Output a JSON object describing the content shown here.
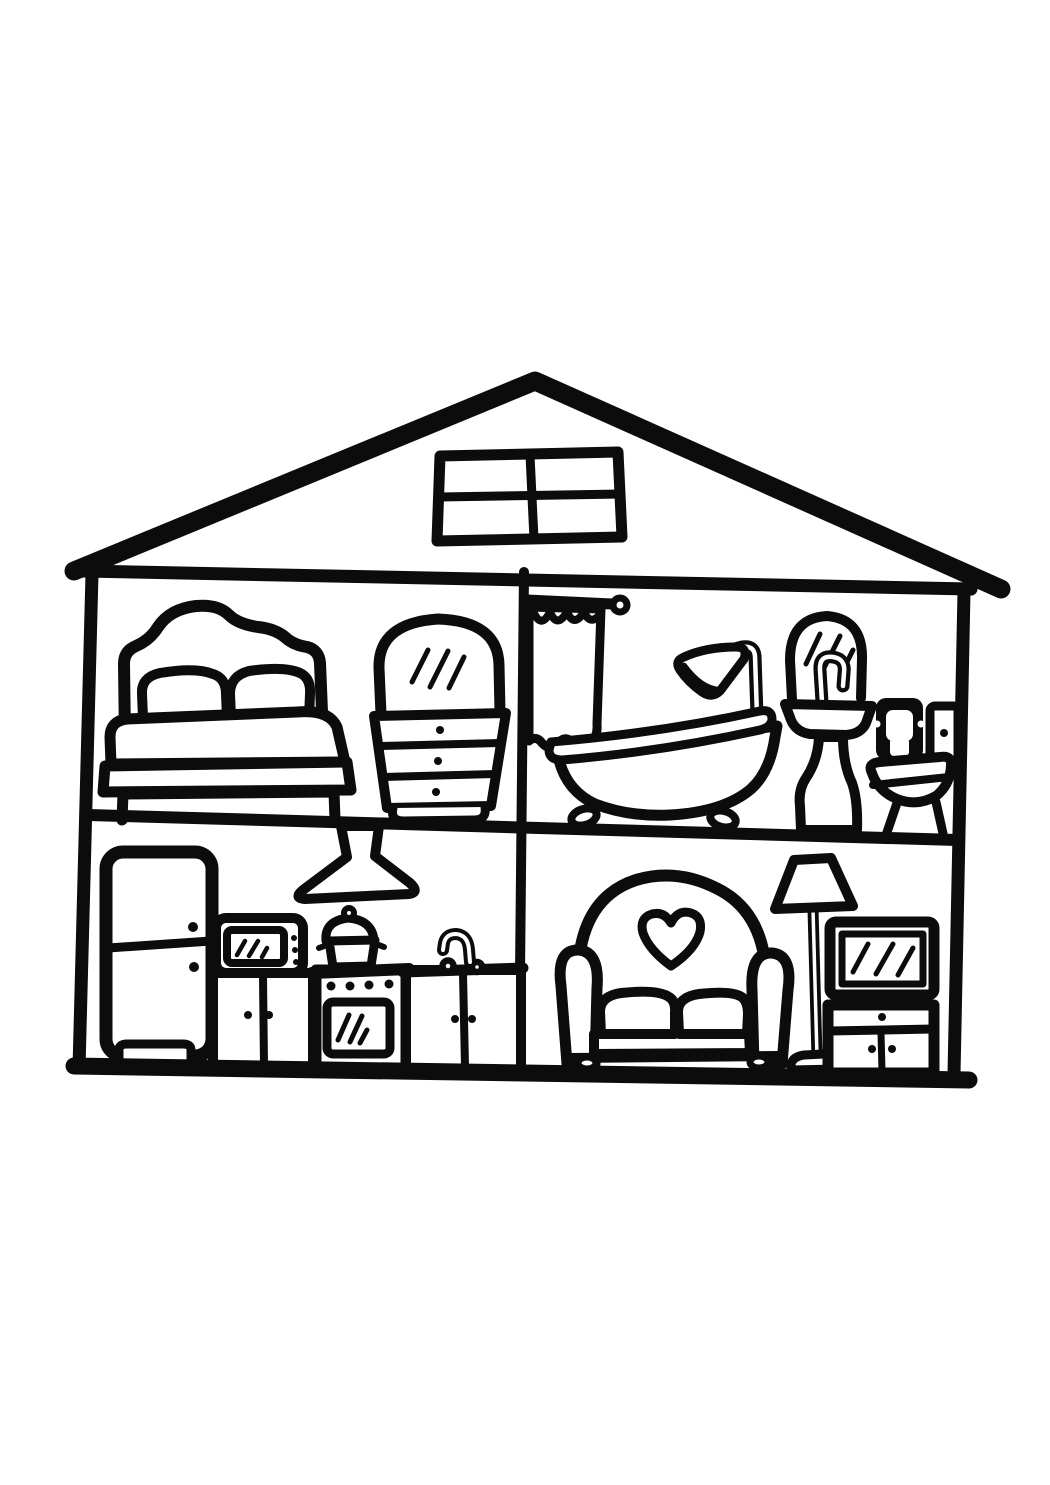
{
  "scene": {
    "title": "Dollhouse cross-section coloring page",
    "style": "hand-drawn black outline line art on white paper",
    "palette": {
      "ink": "#0c0c0c",
      "paper": "#ffffff"
    }
  },
  "house": {
    "exterior": [
      "gable roof",
      "attic window with four panes"
    ],
    "rooms": [
      {
        "name": "bedroom",
        "position": "upper-left",
        "items": [
          "bed with curvy headboard and two pillows",
          "dresser with three drawers",
          "arched vanity mirror"
        ]
      },
      {
        "name": "bathroom",
        "position": "upper-right",
        "items": [
          "shower rod and curtain",
          "clawfoot bathtub",
          "shower head",
          "pedestal sink",
          "arched mirror",
          "toilet-paper holder",
          "toilet"
        ]
      },
      {
        "name": "kitchen",
        "position": "lower-left",
        "items": [
          "refrigerator",
          "range hood",
          "microwave",
          "cooking pot",
          "stove with oven",
          "sink faucet",
          "cabinets"
        ]
      },
      {
        "name": "living-room",
        "position": "lower-right",
        "items": [
          "loveseat with heart back",
          "floor lamp",
          "television",
          "tv cabinet"
        ]
      }
    ]
  }
}
